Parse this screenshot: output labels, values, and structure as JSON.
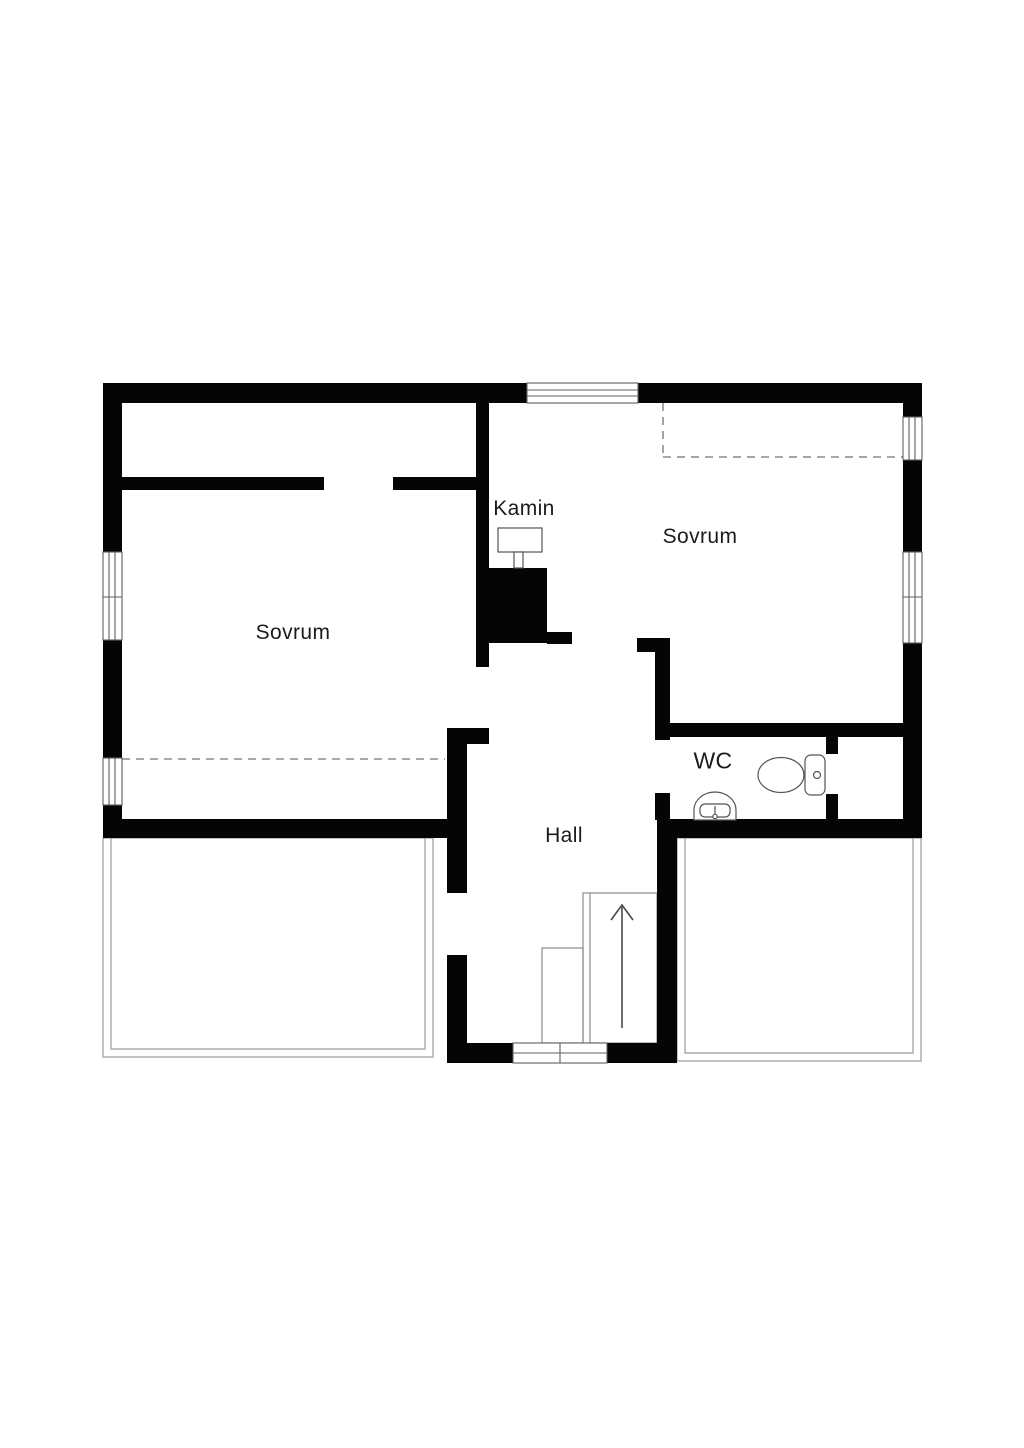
{
  "plan": {
    "type": "floor-plan",
    "labels": {
      "bedroom_left": "Sovrum",
      "bedroom_right": "Sovrum",
      "fireplace": "Kamin",
      "wc": "WC",
      "hall": "Hall"
    },
    "colors": {
      "background": "#ffffff",
      "wall": "#050505",
      "window_line": "#5f5f5f",
      "thin_line": "#9a9a9a",
      "stair_line": "#8b8b8b",
      "dashed_line": "#8c8c8c",
      "fixture_line": "#555555",
      "arrow": "#4a4a4a",
      "text": "#1b1b1b"
    },
    "icons": {
      "toilet": "toilet-icon",
      "sink": "sink-icon",
      "fireplace": "fireplace-icon",
      "stairs_arrow": "stairs-up-arrow-icon",
      "window": "window-icon",
      "low_ceiling": "dashed-ceiling-line"
    }
  }
}
